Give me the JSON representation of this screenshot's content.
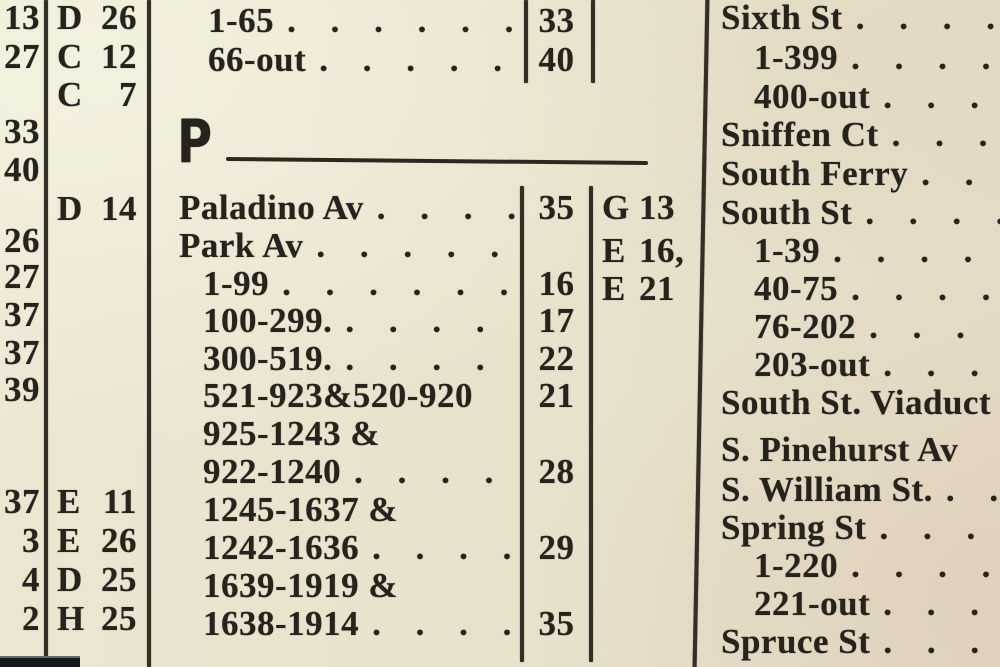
{
  "colors": {
    "paper": "#e8e2cc",
    "ink": "#26221c",
    "rule": "#332e26",
    "photo_edge": "#17191a"
  },
  "index": {
    "left_margin_pages": [
      {
        "v": "13",
        "y": 5
      },
      {
        "v": "27",
        "y": 44
      },
      {
        "v": "33",
        "y": 119
      },
      {
        "v": "40",
        "y": 157
      },
      {
        "v": "26",
        "y": 228
      },
      {
        "v": "27",
        "y": 264
      },
      {
        "v": "37",
        "y": 302
      },
      {
        "v": "37",
        "y": 340
      },
      {
        "v": "39",
        "y": 377
      },
      {
        "v": "37",
        "y": 489
      },
      {
        "v": "3",
        "y": 528
      },
      {
        "v": "4",
        "y": 567
      },
      {
        "v": "2",
        "y": 606
      }
    ],
    "left_margin_grids": [
      {
        "letter": "D",
        "num": "26",
        "y": 5
      },
      {
        "letter": "C",
        "num": "12",
        "y": 44
      },
      {
        "letter": "C",
        "num": "7",
        "y": 82
      },
      {
        "letter": "D",
        "num": "14",
        "y": 196
      },
      {
        "letter": "E",
        "num": "11",
        "y": 489
      },
      {
        "letter": "E",
        "num": "26",
        "y": 528
      },
      {
        "letter": "D",
        "num": "25",
        "y": 567
      },
      {
        "letter": "H",
        "num": "25",
        "y": 606
      }
    ],
    "middle": {
      "carryover_rows": [
        {
          "name": "1-65",
          "dots": ". . . . . . .",
          "page": "33",
          "indent": 0,
          "y": 8
        },
        {
          "name": "66-out",
          "dots": ". . . . . .",
          "page": "40",
          "indent": 0,
          "y": 47
        }
      ],
      "section_letter": "P",
      "rows": [
        {
          "name": "Paladino Av",
          "dots": ". . . .",
          "page": "35",
          "indent": 0,
          "y": 195
        },
        {
          "name": "Park Av",
          "dots": ". . . . . .",
          "page": "",
          "indent": 0,
          "y": 233
        },
        {
          "name": "1-99",
          "dots": ". . . . . . .",
          "page": "16",
          "indent": 1,
          "y": 271
        },
        {
          "name": "100-299.",
          "dots": ". . . . .",
          "page": "17",
          "indent": 1,
          "y": 308
        },
        {
          "name": "300-519.",
          "dots": ". . . . .",
          "page": "22",
          "indent": 1,
          "y": 346
        },
        {
          "name": "521-923&520-920",
          "dots": "",
          "page": "21",
          "indent": 1,
          "y": 383
        },
        {
          "name": "925-1243 &",
          "dots": "",
          "page": "",
          "indent": 1,
          "y": 421
        },
        {
          "name": "922-1240",
          "dots": ". . . . .",
          "page": "28",
          "indent": 1,
          "y": 459
        },
        {
          "name": "1245-1637 &",
          "dots": "",
          "page": "",
          "indent": 1,
          "y": 497
        },
        {
          "name": "1242-1636",
          "dots": ". . . .",
          "page": "29",
          "indent": 1,
          "y": 535
        },
        {
          "name": "1639-1919 &",
          "dots": "",
          "page": "",
          "indent": 1,
          "y": 573
        },
        {
          "name": "1638-1914",
          "dots": ". . . .",
          "page": "35",
          "indent": 1,
          "y": 611
        }
      ],
      "grid_refs": [
        {
          "letter": "G",
          "num": "13",
          "y": 195
        },
        {
          "letter": "E",
          "num": "16,",
          "y": 238
        },
        {
          "letter": "E",
          "num": "21",
          "y": 276
        }
      ]
    },
    "right": {
      "rows": [
        {
          "name": "Sixth St",
          "dots": ". . . .",
          "indent": 0,
          "y": 5
        },
        {
          "name": "1-399",
          "dots": ". . . . . .",
          "indent": 1,
          "y": 45
        },
        {
          "name": "400-out",
          "dots": ". . . .",
          "indent": 1,
          "y": 84
        },
        {
          "name": "Sniffen Ct",
          "dots": ". . .",
          "indent": 0,
          "y": 122
        },
        {
          "name": "South Ferry",
          "dots": ". .",
          "indent": 0,
          "y": 161
        },
        {
          "name": "South St",
          "dots": ". . . .",
          "indent": 0,
          "y": 200
        },
        {
          "name": "1-39",
          "dots": ". . . . .",
          "indent": 1,
          "y": 238
        },
        {
          "name": "40-75",
          "dots": ". . . . .",
          "indent": 1,
          "y": 276
        },
        {
          "name": "76-202",
          "dots": ". . . .",
          "indent": 1,
          "y": 314
        },
        {
          "name": "203-out",
          "dots": ". . . .",
          "indent": 1,
          "y": 352
        },
        {
          "name": "South St. Viaduct",
          "dots": "",
          "indent": 0,
          "y": 390
        },
        {
          "name": "S. Pinehurst Av",
          "dots": "",
          "indent": 0,
          "y": 437
        },
        {
          "name": "S. William St.",
          "dots": ". .",
          "indent": 0,
          "y": 477
        },
        {
          "name": "Spring St",
          "dots": ". . . .",
          "indent": 0,
          "y": 515
        },
        {
          "name": "1-220",
          "dots": ". . . . .",
          "indent": 1,
          "y": 553
        },
        {
          "name": "221-out",
          "dots": ". . . .",
          "indent": 1,
          "y": 591
        },
        {
          "name": "Spruce St",
          "dots": ". . .",
          "indent": 0,
          "y": 629
        }
      ]
    }
  }
}
